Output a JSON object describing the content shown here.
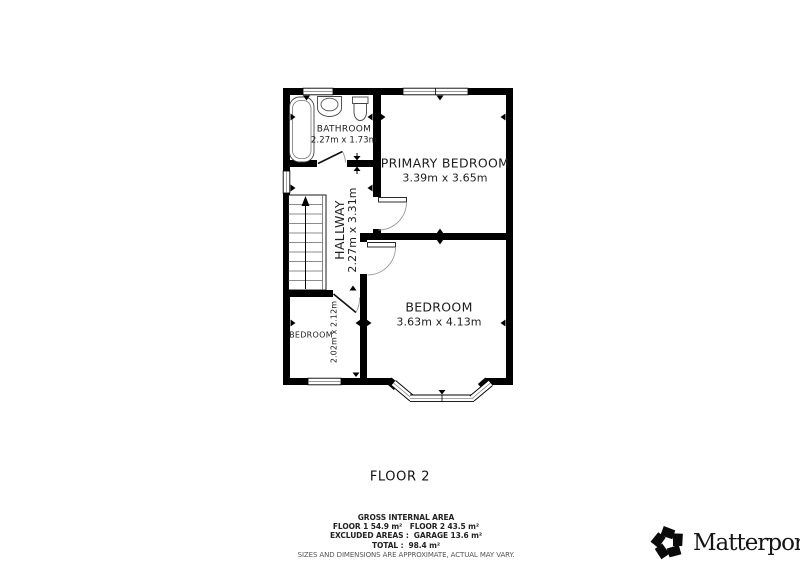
{
  "floor_plan": {
    "floor_label": "FLOOR 2",
    "rooms": [
      {
        "name": "BATHROOM",
        "dimensions": "2.27m x 1.73m"
      },
      {
        "name": "PRIMARY BEDROOM",
        "dimensions": "3.39m x 3.65m"
      },
      {
        "name": "HALLWAY",
        "dimensions": "2.27m x 3.31m"
      },
      {
        "name": "BEDROOM",
        "dimensions": "2.02m x 2.12m"
      },
      {
        "name": "BEDROOM",
        "dimensions": "3.63m x 4.13m"
      }
    ]
  },
  "area_summary": {
    "title": "GROSS INTERNAL AREA",
    "floors_line": "FLOOR 1 54.9 m²   FLOOR 2 43.5 m²",
    "excluded_line": "EXCLUDED AREAS :  GARAGE 13.6 m²",
    "total_line": "TOTAL :  98.4 m²",
    "disclaimer": "SIZES AND DIMENSIONS ARE APPROXIMATE, ACTUAL MAY VARY."
  },
  "branding": {
    "logo_text": "Matterport",
    "registered": "®"
  },
  "colors": {
    "wall": "#000000",
    "fixture_outline": "#555555",
    "text": "#1d1d1d"
  }
}
